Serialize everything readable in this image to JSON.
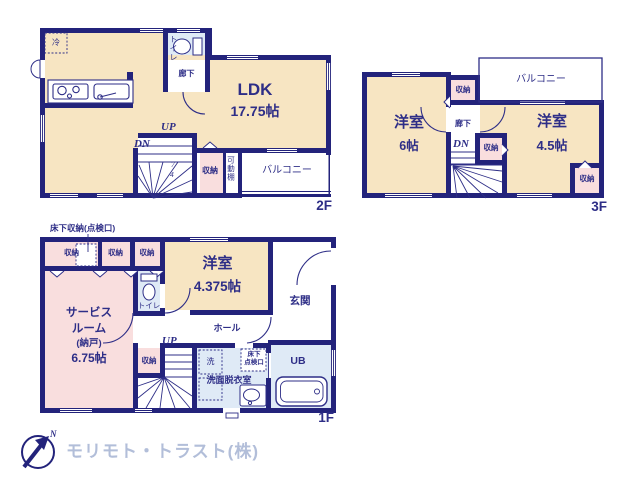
{
  "colors": {
    "wall": "#23237b",
    "text": "#2e2e87",
    "room_cream": "#f7e5c2",
    "closet_pink": "#f9dede",
    "wet_blue": "#dfeaf6",
    "logo_gray_blue": "#b2bed9"
  },
  "f2": {
    "floor_label": "2F",
    "fridge": "冷",
    "toilet": "トイレ",
    "hall": "廊下",
    "ldk": "LDK",
    "ldk_size": "17.75帖",
    "up": "UP",
    "dn": "DN",
    "step_num_top": "7",
    "step_num_bottom": "4",
    "closet": "収納",
    "shelf": "可動棚",
    "balcony": "バルコニー"
  },
  "f3": {
    "floor_label": "3F",
    "balcony": "バルコニー",
    "closet_top": "収納",
    "room6": "洋室",
    "room6_size": "6帖",
    "hall": "廊下",
    "dn": "DN",
    "closet_mid": "収納",
    "room45": "洋室",
    "room45_size": "4.5帖",
    "closet_corner": "収納"
  },
  "f1": {
    "floor_label": "1F",
    "underfloor_note": "床下収納(点検口)",
    "closet_a": "収納",
    "closet_b": "収納",
    "closet_c": "収納",
    "room": "洋室",
    "room_size": "4.375帖",
    "entrance": "玄関",
    "service_1": "サービス",
    "service_2": "ルーム",
    "service_3": "(納戸)",
    "service_4": "6.75帖",
    "toilet": "トイレ",
    "hall": "ホール",
    "up": "UP",
    "closet_d": "収納",
    "washer": "洗",
    "hatch_1": "床下",
    "hatch_2": "点検口",
    "washroom": "洗面脱衣室",
    "bath": "UB"
  },
  "footer": {
    "north": "N",
    "company": "モリモト・トラスト(株)"
  }
}
